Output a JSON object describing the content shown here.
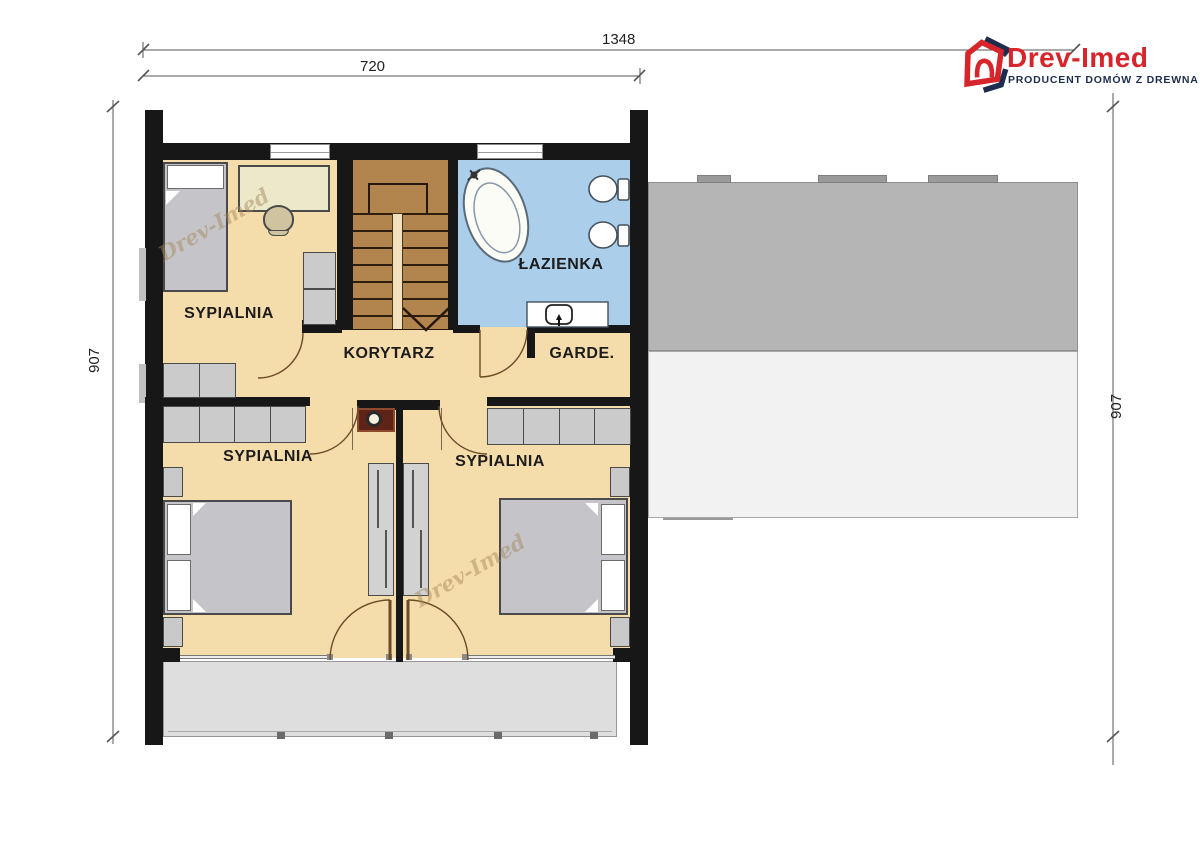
{
  "logo": {
    "brand": "Drev-Imed",
    "tagline": "PRODUCENT DOMÓW Z DREWNA"
  },
  "watermark": {
    "text": "Drev-Imed"
  },
  "dimensions": {
    "top_total": "1348",
    "top_inner": "720",
    "left_height": "907",
    "right_height": "907"
  },
  "rooms": {
    "bedroom_top_left": {
      "label": "SYPIALNIA"
    },
    "bathroom": {
      "label": "ŁAZIENKA"
    },
    "corridor": {
      "label": "KORYTARZ"
    },
    "wardrobe": {
      "label": "GARDE."
    },
    "bedroom_bottom_left": {
      "label": "SYPIALNIA"
    },
    "bedroom_bottom_right": {
      "label": "SYPIALNIA"
    }
  },
  "colors": {
    "floor": "#f5dcab",
    "bathroom_floor": "#abceeb",
    "stairs": "#b2854f",
    "roof_dark": "#b5b5b5",
    "roof_light": "#f2f2f2",
    "terrace": "#dedede",
    "wall": "#171717",
    "furniture": "#cbcbcb",
    "chimney": "#5e2418",
    "logo_red": "#d6252b",
    "logo_navy": "#1e2c4e"
  }
}
